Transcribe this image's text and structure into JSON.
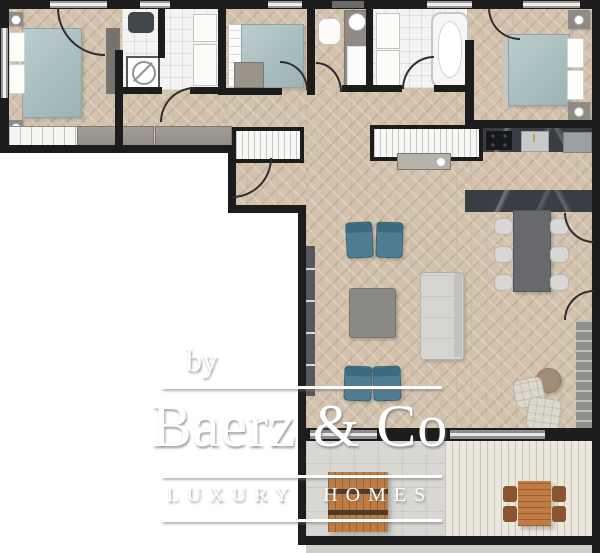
{
  "watermark": {
    "by": "by",
    "brand": "Baerz & Co",
    "tagline": "LUXURY HOMES"
  },
  "colors": {
    "wall": "#1c1c1c",
    "floor": "#d3c2ae",
    "tile": "#f3f3f2",
    "terrace": "#d8d7d3",
    "deck": "#ebe7dd",
    "marble": "#3a3e44",
    "bed": "#a9bec0",
    "chair": "#4e7d93",
    "sofa": "#d5d4cf",
    "wood": "#c07c42",
    "watermark": "#ffffff"
  }
}
